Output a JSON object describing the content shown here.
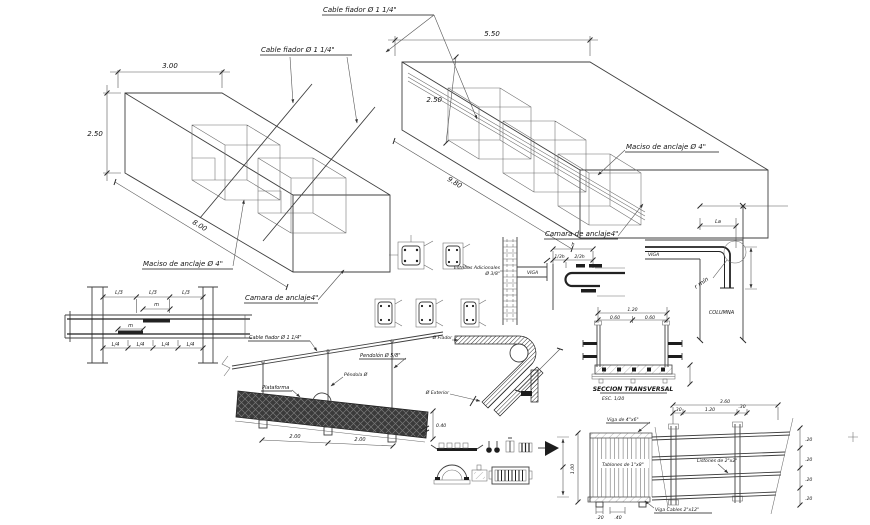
{
  "drawing": {
    "iso_left": {
      "cable_label": "Cable fiador Ø 1 1/4\"",
      "dim_width": "3.00",
      "dim_height": "2.50",
      "dim_length": "8.00",
      "maciso_label": "Maciso de anclaje Ø 4\"",
      "camara_label": "Camara de anclaje4\""
    },
    "iso_right": {
      "cable_label": "Cable fiador Ø 1 1/4\"",
      "dim_width": "5.50",
      "dim_height": "2.50",
      "dim_length": "9.80",
      "maciso_label": "Maciso de anclaje Ø 4\"",
      "camara_label": "Camara de anclaje4\""
    },
    "beam_elevation": {
      "top_dims": [
        "L/3",
        "L/3",
        "L/3"
      ],
      "lap_top": "m",
      "lap_bottom": "m",
      "bottom_dims": [
        "L/4",
        "L/4",
        "L/4",
        "L/4"
      ]
    },
    "column_splice": {
      "beam_label": "VIGA",
      "stirrups_label_1": "Estribos Adicionales",
      "stirrups_label_2": "Ø 3/8\""
    },
    "hook_detail": {
      "dim_h": "h",
      "dim_third": "1/3h",
      "dim_two_third": "2/3h"
    },
    "corner_joint": {
      "beam_label": "VIGA",
      "column_label": "COLUMNA",
      "radius_label": "r mín",
      "anchorage_dim": "La"
    },
    "walkway_elevation": {
      "cable_label": "Cable fiador Ø 1 1/4\"",
      "pendolon_label": "Pendolón Ø 5/8\"",
      "pendola_label": "Péndola Ø",
      "platform_label": "Plataforma",
      "span_dim_1": "2.00",
      "span_dim_2": "2.00",
      "depth_dim": "0.40"
    },
    "saddle_detail": {
      "fiador_label": "Ø Fiador",
      "exterior_label": "Ø Exterior"
    },
    "cross_section": {
      "title": "SECCION TRANSVERSAL",
      "scale": "ESC. 1/20",
      "dim_total": "1.20",
      "dim_half_1": "0.60",
      "dim_half_2": "0.60"
    },
    "deck_plan": {
      "beam_label": "Viga de 4\"x6\"",
      "planks_label": "Tablones de 1\"x8\"",
      "cable_beam_label": "Viga Cables 2\"x12\"",
      "battens_label": "Listones de 2\"x2\"",
      "dim_top": "3.60",
      "dim_row2_a": ".30",
      "dim_row2_b": "1.20",
      "dim_row2_c": ".30",
      "dim_left": "1.00",
      "dim_bottom_a": ".20",
      "dim_bottom_b": ".40",
      "dim_right_1": ".20",
      "dim_right_2": ".20",
      "dim_right_3": ".20",
      "dim_right_4": ".20"
    }
  }
}
